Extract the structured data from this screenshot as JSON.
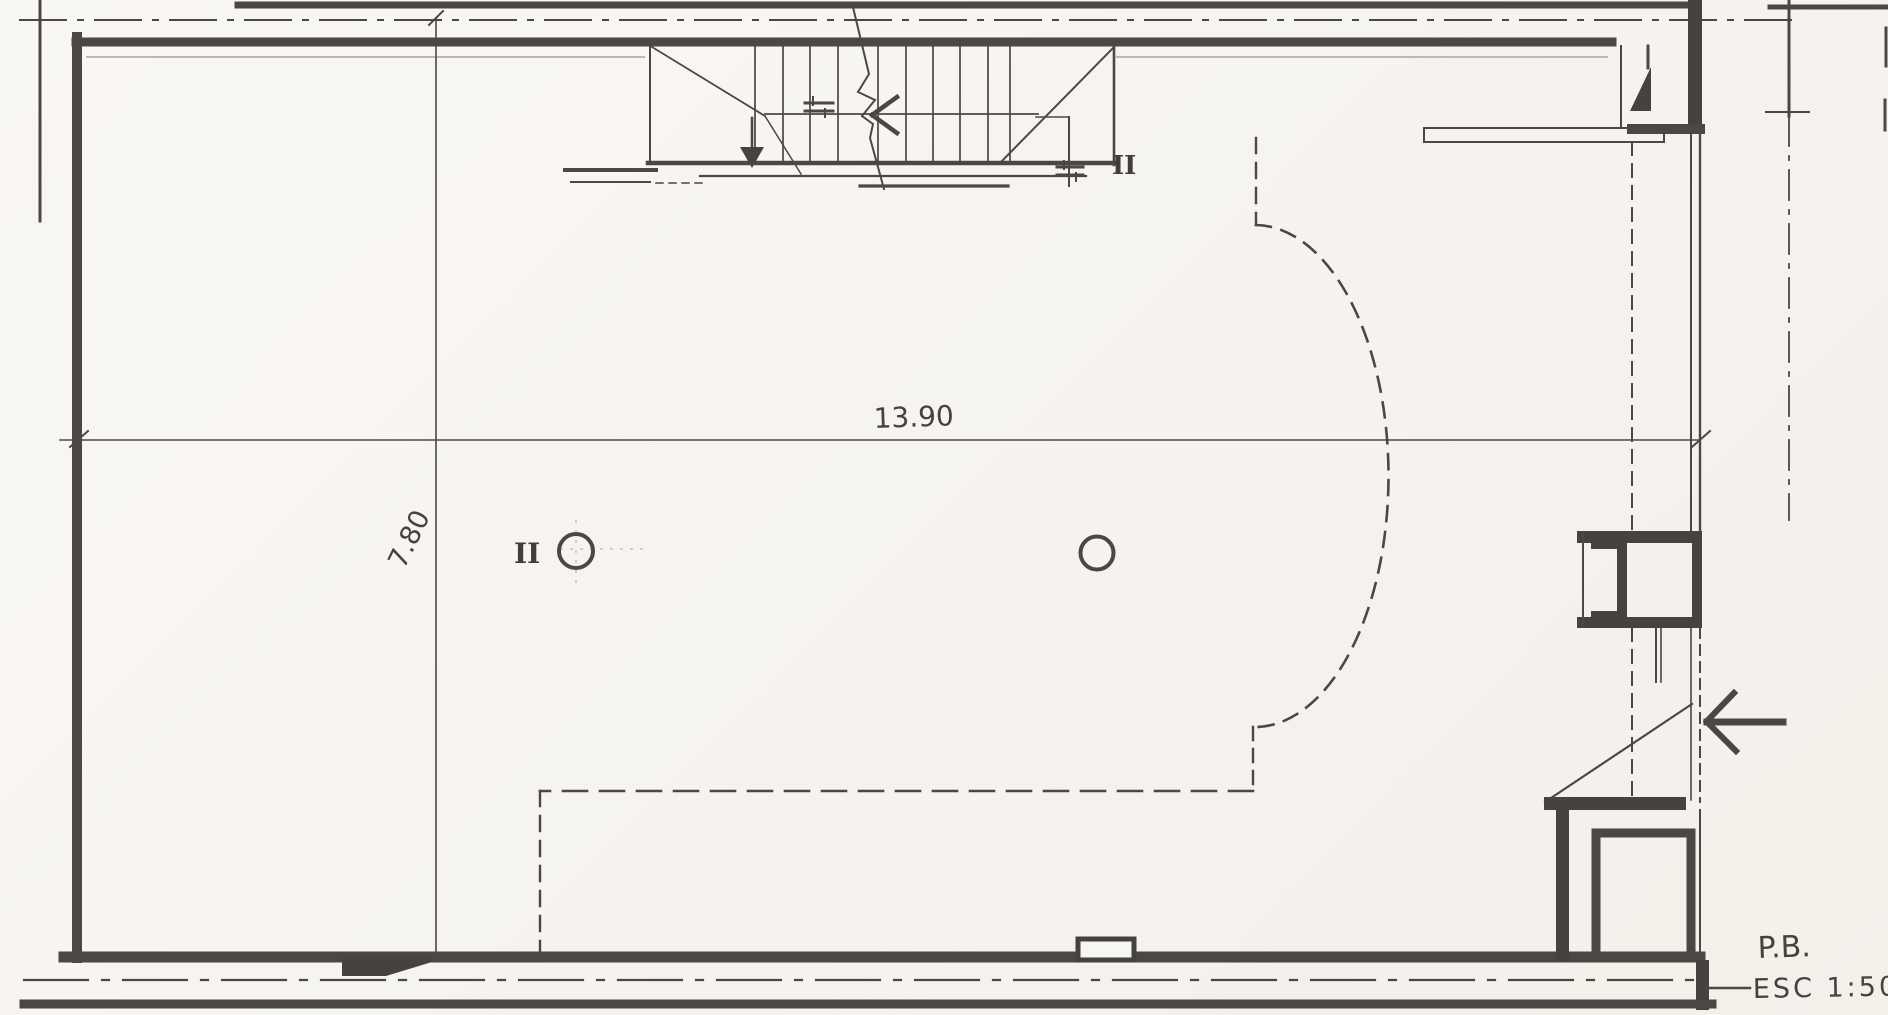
{
  "plan": {
    "title": "P.B.",
    "scale_label": "ESC 1:50",
    "scale_value": "1:50",
    "dimensions": {
      "width_label": "13.90",
      "height_label": "7.80",
      "width_m": 13.9,
      "height_m": 7.8
    },
    "markers": {
      "column_left": "II",
      "stair_column": "II"
    },
    "colors": {
      "paper": "#f8f6f2",
      "ink_dark": "#45423f",
      "ink_medium": "#5a5753",
      "ink_light": "#6e6a66",
      "faint": "#a8a49d"
    }
  }
}
